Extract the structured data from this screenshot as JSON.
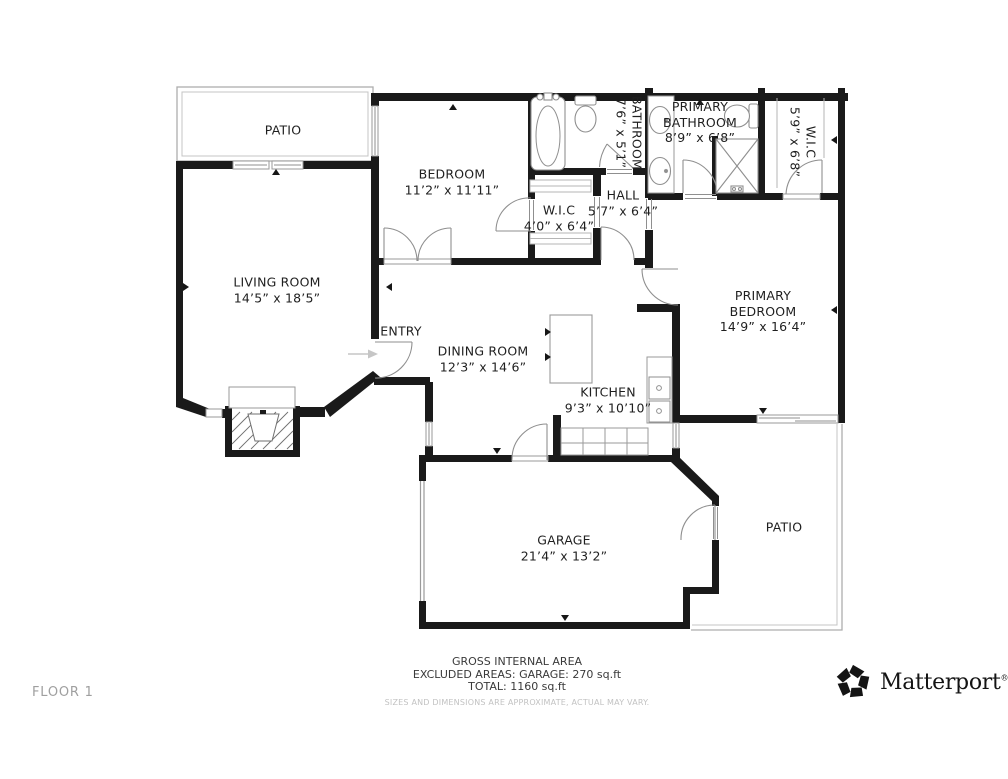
{
  "meta": {
    "floor_label": "FLOOR 1"
  },
  "rooms": {
    "patio_top": {
      "label": "PATIO"
    },
    "bedroom": {
      "label": "BEDROOM",
      "dims": "11’2” x 11’11”"
    },
    "bathroom": {
      "label": "BATHROOM",
      "dims": "7’6” x 5’1”"
    },
    "primary_bathroom": {
      "line1": "PRIMARY",
      "line2": "BATHROOM",
      "dims": "8’9” x 6’8”"
    },
    "wic_right": {
      "label": "W.I.C",
      "dims": "5’9” x 6’8”"
    },
    "wic_hall": {
      "label": "W.I.C",
      "dims": "4’0” x 6’4”"
    },
    "hall": {
      "label": "HALL",
      "dims": "5’7” x 6’4”"
    },
    "living_room": {
      "label": "LIVING ROOM",
      "dims": "14’5” x 18’5”"
    },
    "entry": {
      "label": "ENTRY"
    },
    "dining_room": {
      "label": "DINING ROOM",
      "dims": "12’3” x 14’6”"
    },
    "kitchen": {
      "label": "KITCHEN",
      "dims": "9’3” x 10’10”"
    },
    "primary_bedroom": {
      "line1": "PRIMARY",
      "line2": "BEDROOM",
      "dims": "14’9” x 16’4”"
    },
    "garage": {
      "label": "GARAGE",
      "dims": "21’4” x 13’2”"
    },
    "patio_right": {
      "label": "PATIO"
    }
  },
  "footer": {
    "gross_internal_area": "GROSS INTERNAL AREA",
    "excluded_areas": "EXCLUDED AREAS: GARAGE: 270 sq.ft",
    "total": "TOTAL: 1160 sq.ft",
    "disclaimer": "SIZES AND DIMENSIONS ARE APPROXIMATE, ACTUAL MAY VARY."
  },
  "brand": {
    "name": "Matterport",
    "registered": "®"
  },
  "colors": {
    "wall": "#1a1a1a",
    "fixture_line": "#8f8f8f",
    "thin_line": "#a8a8a8",
    "label_text": "#1f1f1f",
    "muted_text": "#9f9f9f",
    "disclaimer_text": "#c2c2c2"
  }
}
